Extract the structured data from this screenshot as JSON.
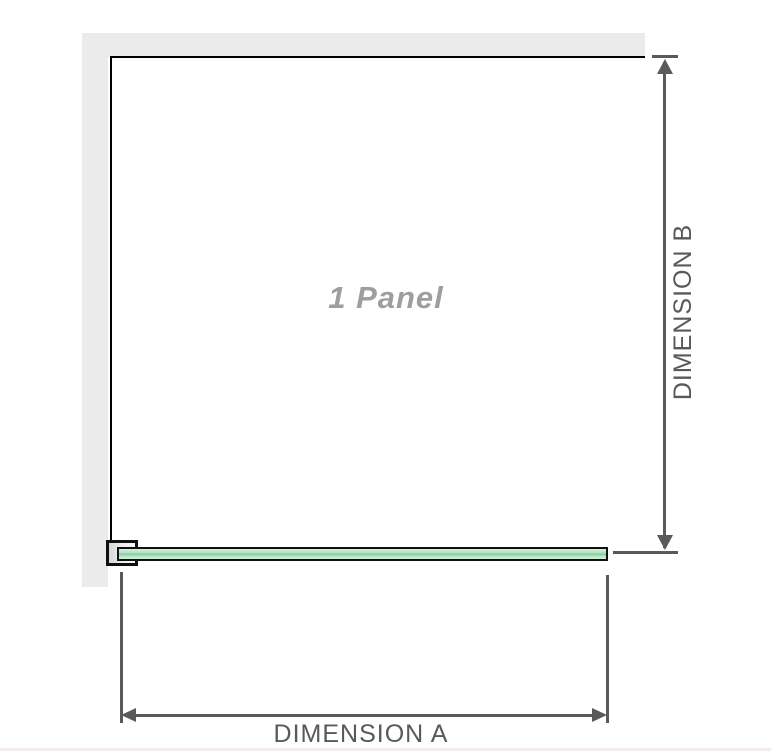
{
  "labels": {
    "panel": "1 Panel",
    "dimension_a": "DIMENSION A",
    "dimension_b": "DIMENSION B"
  },
  "colors": {
    "wall": "#ebebeb",
    "panel_outline": "#000000",
    "glass_fill_light": "#d3f0df",
    "glass_fill": "#b4e2c1",
    "glass_stripe": "#7fca93",
    "dimension_line": "#595a5c",
    "dimension_text": "#58595b",
    "panel_label_text": "#9e9e9e",
    "bottom_rule": "#f2ecec"
  }
}
